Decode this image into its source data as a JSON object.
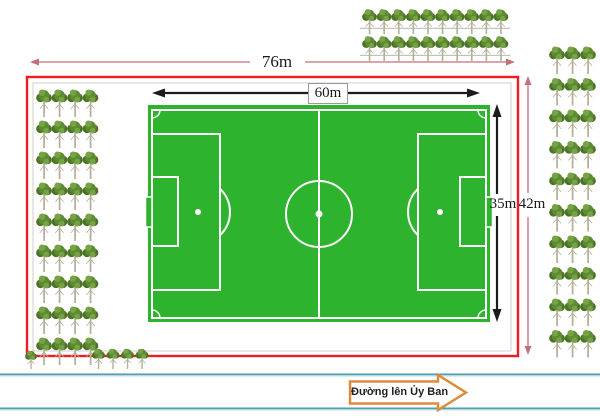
{
  "title": "Football field site plan",
  "colors": {
    "field_green": "#2eb32e",
    "line_white": "#ffffff",
    "boundary_red": "#ee1c25",
    "dim_pink": "#c4707a",
    "dim_black": "#1c1c1c",
    "road_teal": "#4e9cae",
    "road_teal_light": "#aed6e0",
    "sign_orange": "#e08a3c",
    "inner_gray": "#cfcfcf",
    "tree_crown_dark": "#4c7226",
    "tree_crown": "#5d8b33",
    "tree_crown_light": "#76a344",
    "tree_trunk": "#b5b09a"
  },
  "dimensions": {
    "outer_width": {
      "label": "76m",
      "orientation": "horizontal",
      "color": "pink"
    },
    "field_width": {
      "label": "60m",
      "orientation": "horizontal",
      "color": "black"
    },
    "field_height": {
      "label": "35m",
      "orientation": "vertical",
      "color": "black"
    },
    "outer_height": {
      "label": "42m",
      "orientation": "vertical",
      "color": "pink"
    }
  },
  "road": {
    "label": "Đường lên Ủy Ban"
  },
  "trees": {
    "left_block": {
      "rows": 9,
      "cols": 4,
      "x": 36,
      "y": 88,
      "dx": 15.5,
      "dy": 31,
      "w": 16,
      "h": 29
    },
    "top_block": {
      "rows": 2,
      "cols": 10,
      "x": 362,
      "y": 8,
      "dx": 14.6,
      "dy": 27,
      "w": 15,
      "h": 26,
      "ground_line": true
    },
    "right_block": {
      "rows": 10,
      "cols": 3,
      "x": 549,
      "y": 45,
      "dx": 15.5,
      "dy": 31.5,
      "w": 16,
      "h": 29
    },
    "bottom_row": {
      "rows": 1,
      "cols": 4,
      "x": 92,
      "y": 348,
      "dx": 14.5,
      "dy": 0,
      "w": 13,
      "h": 21
    },
    "corner_tree": {
      "rows": 1,
      "cols": 1,
      "x": 25,
      "y": 350,
      "dx": 0,
      "dy": 0,
      "w": 12,
      "h": 19
    }
  }
}
